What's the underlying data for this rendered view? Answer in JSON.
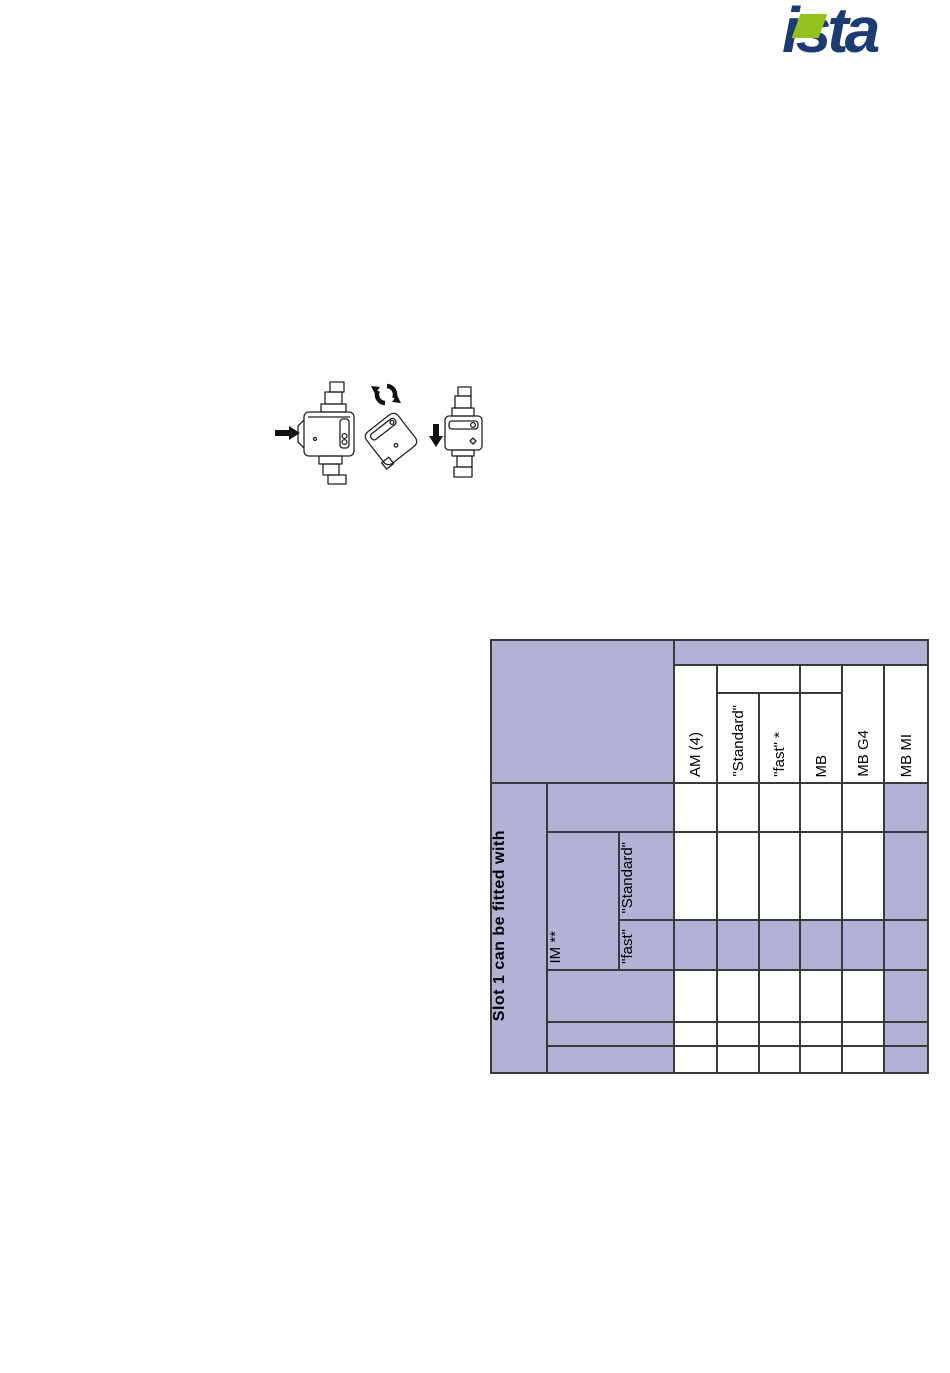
{
  "logo": {
    "text": "ista",
    "color_blue": "#1d3b73",
    "color_green": "#95c11e"
  },
  "figures": {
    "icons": [
      "flow-arrow-right-icon",
      "meter-front-drawing",
      "rotation-arrows-icon",
      "meter-tilted-45-drawing",
      "flow-arrow-down-icon",
      "meter-side-drawing"
    ]
  },
  "table": {
    "colors": {
      "header_fill": "#b2b1d6",
      "cell_fill": "#ffffff",
      "border": "#3a3a3a"
    },
    "left": {
      "group": "Slot 1 can be fitted with",
      "im": "IM **",
      "im_standard": "\"Standard\"",
      "im_fast": "\"fast\""
    },
    "col_headers": [
      "AM (4)",
      "\"Standard\"",
      "\"fast\" *",
      "MB",
      "MB G4",
      "MB MI"
    ],
    "matrix": [
      [
        "white",
        "white",
        "white",
        "white",
        "white",
        "purple"
      ],
      [
        "white",
        "white",
        "white",
        "white",
        "white",
        "purple"
      ],
      [
        "purple",
        "purple",
        "purple",
        "purple",
        "purple",
        "purple"
      ],
      [
        "white",
        "white",
        "white",
        "white",
        "white",
        "purple"
      ],
      [
        "white",
        "white",
        "white",
        "white",
        "white",
        "purple"
      ],
      [
        "white",
        "white",
        "white",
        "white",
        "white",
        "purple"
      ]
    ]
  }
}
